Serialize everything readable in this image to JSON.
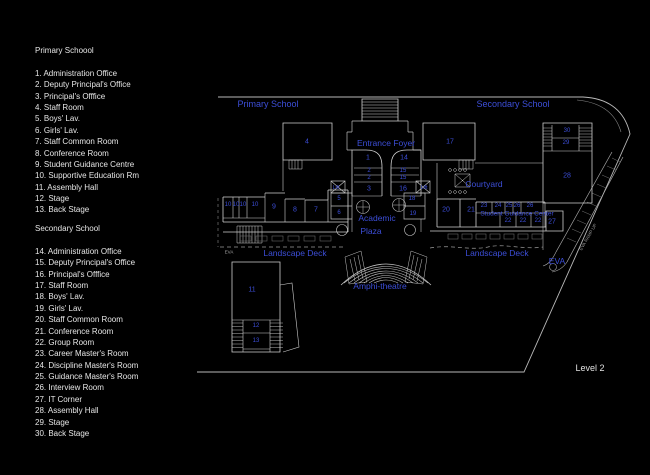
{
  "window": {
    "background": "#000000"
  },
  "colors": {
    "accent_blue": "#3c4ed8",
    "legend_text": "#e6e6e6",
    "wall_line": "#cfcfcf",
    "dim_line": "#8a8a8a"
  },
  "legend": {
    "primary": {
      "heading": "Primary Schoool",
      "items": [
        "1. Administration Office",
        "2. Deputy Principal's Office",
        "3. Principal's Offfice",
        "4. Staff Room",
        "5. Boys' Lav.",
        "6. Girls' Lav.",
        "7. Staff Common Room",
        "8. Conference Room",
        "9. Student Guidance Centre",
        "10. Supportive Education Rm",
        "11. Assembly Hall",
        "12. Stage",
        "13. Back Stage"
      ]
    },
    "secondary": {
      "heading": "Secondary School",
      "items": [
        "14. Administration Office",
        "15. Deputy Principal's Office",
        "16. Principal's Offfice",
        "17. Staff Room",
        "18. Boys' Lav.",
        "19. Girls' Lav.",
        "20. Staff Common Room",
        "21. Conference Room",
        "22. Group Room",
        "23. Career Master's Room",
        "24. Discipline Master's Room",
        "25. Guidance Master's Room",
        "26. Interview Room",
        "27. IT Corner",
        "28. Assembly Hall",
        "29. Stage",
        "30. Back Stage"
      ]
    }
  },
  "plan": {
    "labels": [
      {
        "name": "primary-school-area-label",
        "text": "Primary School",
        "x": 268,
        "y": 104,
        "s": 9
      },
      {
        "name": "secondary-school-area-label",
        "text": "Secondary School",
        "x": 513,
        "y": 104,
        "s": 9
      },
      {
        "name": "entrance-foyer-label",
        "text": "Entrance Foyer",
        "x": 386,
        "y": 143,
        "s": 8.5
      },
      {
        "name": "courtyard-label",
        "text": "Courtyard",
        "x": 484,
        "y": 184,
        "s": 8.5
      },
      {
        "name": "academic-plaza-label-line1",
        "text": "Academic",
        "x": 377,
        "y": 218,
        "s": 8.5
      },
      {
        "name": "academic-plaza-label-line2",
        "text": "Plaza",
        "x": 371,
        "y": 231,
        "s": 8.5
      },
      {
        "name": "landscape-deck-west-label",
        "text": "Landscape Deck",
        "x": 295,
        "y": 253,
        "s": 8.5
      },
      {
        "name": "landscape-deck-east-label",
        "text": "Landscape Deck",
        "x": 497,
        "y": 253,
        "s": 8.5
      },
      {
        "name": "amphitheatre-label",
        "text": "Amphi-theatre",
        "x": 380,
        "y": 286,
        "s": 8.5
      },
      {
        "name": "eva-label",
        "text": "EVA",
        "x": 557,
        "y": 261,
        "s": 8.5
      },
      {
        "name": "student-guidance-center-label",
        "text": "Student Guidance Center",
        "x": 517,
        "y": 214,
        "s": 6.5
      },
      {
        "name": "lift-west-label",
        "text": "Lift",
        "x": 336,
        "y": 188,
        "s": 5
      },
      {
        "name": "lift-east-label",
        "text": "Lift",
        "x": 424,
        "y": 188,
        "s": 5
      },
      {
        "name": "room-4-label",
        "text": "4",
        "x": 307,
        "y": 142,
        "s": 7
      },
      {
        "name": "room-1-label",
        "text": "1",
        "x": 368,
        "y": 158,
        "s": 7
      },
      {
        "name": "room-14-label",
        "text": "14",
        "x": 404,
        "y": 158,
        "s": 7
      },
      {
        "name": "room-2a-label",
        "text": "2",
        "x": 369,
        "y": 171,
        "s": 6
      },
      {
        "name": "room-2b-label",
        "text": "2",
        "x": 369,
        "y": 178,
        "s": 6
      },
      {
        "name": "room-3-label",
        "text": "3",
        "x": 369,
        "y": 189,
        "s": 7
      },
      {
        "name": "room-15a-label",
        "text": "15",
        "x": 403,
        "y": 171,
        "s": 6
      },
      {
        "name": "room-15b-label",
        "text": "15",
        "x": 403,
        "y": 178,
        "s": 6
      },
      {
        "name": "room-16-label",
        "text": "16",
        "x": 403,
        "y": 189,
        "s": 7
      },
      {
        "name": "room-5-label",
        "text": "5",
        "x": 339,
        "y": 199,
        "s": 6
      },
      {
        "name": "room-6-label",
        "text": "6",
        "x": 339,
        "y": 213,
        "s": 6
      },
      {
        "name": "room-18-label",
        "text": "18",
        "x": 412,
        "y": 199,
        "s": 6
      },
      {
        "name": "room-19-label",
        "text": "19",
        "x": 413,
        "y": 214,
        "s": 6
      },
      {
        "name": "room-10a-label",
        "text": "10",
        "x": 228,
        "y": 205,
        "s": 6
      },
      {
        "name": "room-10b-label",
        "text": "10",
        "x": 236,
        "y": 205,
        "s": 6
      },
      {
        "name": "room-10c-label",
        "text": "10",
        "x": 243,
        "y": 205,
        "s": 6
      },
      {
        "name": "room-10d-label",
        "text": "10",
        "x": 255,
        "y": 205,
        "s": 6
      },
      {
        "name": "room-9-label",
        "text": "9",
        "x": 274,
        "y": 207,
        "s": 7
      },
      {
        "name": "room-8-label",
        "text": "8",
        "x": 295,
        "y": 210,
        "s": 7
      },
      {
        "name": "room-7-label",
        "text": "7",
        "x": 316,
        "y": 210,
        "s": 7
      },
      {
        "name": "room-17-label",
        "text": "17",
        "x": 450,
        "y": 142,
        "s": 7
      },
      {
        "name": "room-30-label",
        "text": "30",
        "x": 567,
        "y": 131,
        "s": 6
      },
      {
        "name": "room-29-label",
        "text": "29",
        "x": 566,
        "y": 143,
        "s": 6
      },
      {
        "name": "room-28-label",
        "text": "28",
        "x": 567,
        "y": 176,
        "s": 7
      },
      {
        "name": "room-20-label",
        "text": "20",
        "x": 446,
        "y": 210,
        "s": 7
      },
      {
        "name": "room-21-label",
        "text": "21",
        "x": 471,
        "y": 210,
        "s": 7
      },
      {
        "name": "room-23-label",
        "text": "23",
        "x": 484,
        "y": 206,
        "s": 6
      },
      {
        "name": "room-24-label",
        "text": "24",
        "x": 498,
        "y": 206,
        "s": 6
      },
      {
        "name": "room-25-label",
        "text": "25",
        "x": 509,
        "y": 206,
        "s": 6
      },
      {
        "name": "room-26a-label",
        "text": "26",
        "x": 517,
        "y": 206,
        "s": 6
      },
      {
        "name": "room-26b-label",
        "text": "26",
        "x": 530,
        "y": 206,
        "s": 6
      },
      {
        "name": "room-22a-label",
        "text": "22",
        "x": 508,
        "y": 221,
        "s": 6
      },
      {
        "name": "room-22b-label",
        "text": "22",
        "x": 523,
        "y": 221,
        "s": 6
      },
      {
        "name": "room-22c-label",
        "text": "22",
        "x": 538,
        "y": 221,
        "s": 6
      },
      {
        "name": "room-27-label",
        "text": "27",
        "x": 552,
        "y": 222,
        "s": 7
      },
      {
        "name": "room-11-label",
        "text": "11",
        "x": 252,
        "y": 290,
        "s": 7
      },
      {
        "name": "room-12-label",
        "text": "12",
        "x": 256,
        "y": 326,
        "s": 6
      },
      {
        "name": "room-13-label",
        "text": "13",
        "x": 256,
        "y": 341,
        "s": 6
      },
      {
        "name": "level-label",
        "text": "Level 2",
        "x": 590,
        "y": 368,
        "s": 9,
        "c": "#e0e0e0"
      },
      {
        "name": "eva-west-tiny-label",
        "text": "EVA",
        "x": 229,
        "y": 252,
        "s": 4.5,
        "c": "#a8a8a8"
      },
      {
        "name": "eva-ramp-label",
        "text": "EVA RAMP UP",
        "x": 588,
        "y": 237,
        "s": 4.5,
        "c": "#9a9a9a",
        "r": -60
      }
    ]
  }
}
